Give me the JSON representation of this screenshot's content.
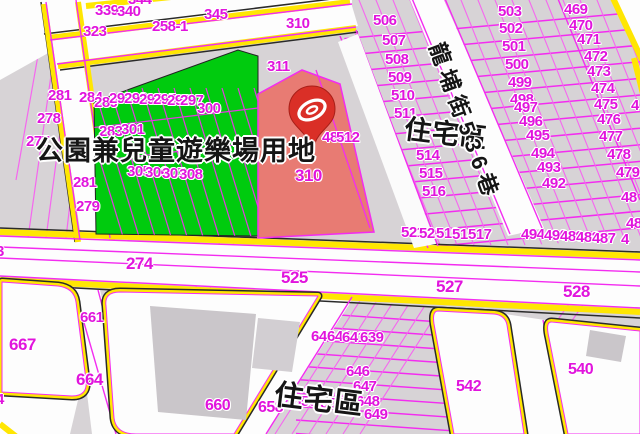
{
  "map": {
    "kind": "cadastral-zoning-map",
    "zone_colors": {
      "park": "#00cb0e",
      "selected_parcel": "#e87b73",
      "road_edge": "#ffe602",
      "parcel_line": "#f32cf0",
      "parcel_label": "#e114dd"
    },
    "marker": {
      "name": "map-pin",
      "on_parcel": "310",
      "color": "#da2f27"
    },
    "zone_texts": {
      "park": "公園兼兒童遊樂場用地",
      "residential_upper": "住宅區",
      "residential_lower": "住宅區",
      "street": "龍埔街536巷"
    },
    "labels": [
      {
        "t": "344",
        "x": 128,
        "y": -8
      },
      {
        "t": "339",
        "x": 95,
        "y": 3
      },
      {
        "t": "340",
        "x": 117,
        "y": 4
      },
      {
        "t": "345",
        "x": 204,
        "y": 7
      },
      {
        "t": "323",
        "x": 83,
        "y": 24
      },
      {
        "t": "258-1",
        "x": 152,
        "y": 19
      },
      {
        "t": "310",
        "x": 286,
        "y": 16
      },
      {
        "t": "311",
        "x": 267,
        "y": 59
      },
      {
        "t": "281",
        "x": 48,
        "y": 88
      },
      {
        "t": "284",
        "x": 79,
        "y": 90
      },
      {
        "t": "278",
        "x": 37,
        "y": 111
      },
      {
        "t": "277",
        "x": 26,
        "y": 134
      },
      {
        "t": "281",
        "x": 73,
        "y": 175
      },
      {
        "t": "279",
        "x": 76,
        "y": 199
      },
      {
        "t": "3",
        "x": -4,
        "y": 244
      },
      {
        "t": "4",
        "x": -4,
        "y": 392
      },
      {
        "t": "289",
        "x": 94,
        "y": 95
      },
      {
        "t": "292",
        "x": 109,
        "y": 91
      },
      {
        "t": "293",
        "x": 124,
        "y": 91
      },
      {
        "t": "294",
        "x": 139,
        "y": 92
      },
      {
        "t": "295",
        "x": 153,
        "y": 92
      },
      {
        "t": "296",
        "x": 167,
        "y": 93
      },
      {
        "t": "297",
        "x": 180,
        "y": 93
      },
      {
        "t": "283",
        "x": 99,
        "y": 124
      },
      {
        "t": "301",
        "x": 121,
        "y": 122
      },
      {
        "t": "300",
        "x": 197,
        "y": 101
      },
      {
        "t": "305",
        "x": 127,
        "y": 164
      },
      {
        "t": "306",
        "x": 145,
        "y": 165
      },
      {
        "t": "307",
        "x": 162,
        "y": 166
      },
      {
        "t": "308",
        "x": 179,
        "y": 167
      },
      {
        "t": "310",
        "x": 295,
        "y": 167,
        "s": 17
      },
      {
        "t": "488",
        "x": 322,
        "y": 130
      },
      {
        "t": "512",
        "x": 336,
        "y": 130
      },
      {
        "t": "506",
        "x": 373,
        "y": 13
      },
      {
        "t": "507",
        "x": 382,
        "y": 33
      },
      {
        "t": "508",
        "x": 385,
        "y": 52
      },
      {
        "t": "509",
        "x": 388,
        "y": 70
      },
      {
        "t": "510",
        "x": 391,
        "y": 88
      },
      {
        "t": "511",
        "x": 394,
        "y": 106
      },
      {
        "t": "514",
        "x": 416,
        "y": 148
      },
      {
        "t": "515",
        "x": 419,
        "y": 166
      },
      {
        "t": "516",
        "x": 422,
        "y": 184
      },
      {
        "t": "503",
        "x": 498,
        "y": 4
      },
      {
        "t": "502",
        "x": 499,
        "y": 21
      },
      {
        "t": "501",
        "x": 502,
        "y": 39
      },
      {
        "t": "500",
        "x": 505,
        "y": 57
      },
      {
        "t": "499",
        "x": 508,
        "y": 75
      },
      {
        "t": "498",
        "x": 510,
        "y": 92
      },
      {
        "t": "497",
        "x": 514,
        "y": 100
      },
      {
        "t": "496",
        "x": 519,
        "y": 114
      },
      {
        "t": "495",
        "x": 526,
        "y": 128
      },
      {
        "t": "494",
        "x": 531,
        "y": 146
      },
      {
        "t": "493",
        "x": 537,
        "y": 160
      },
      {
        "t": "492",
        "x": 542,
        "y": 176
      },
      {
        "t": "469",
        "x": 564,
        "y": 2
      },
      {
        "t": "470",
        "x": 569,
        "y": 18
      },
      {
        "t": "471",
        "x": 577,
        "y": 32
      },
      {
        "t": "472",
        "x": 584,
        "y": 49
      },
      {
        "t": "473",
        "x": 587,
        "y": 64
      },
      {
        "t": "474",
        "x": 591,
        "y": 81
      },
      {
        "t": "475",
        "x": 594,
        "y": 97
      },
      {
        "t": "4",
        "x": 631,
        "y": 98
      },
      {
        "t": "476",
        "x": 597,
        "y": 112
      },
      {
        "t": "477",
        "x": 599,
        "y": 129
      },
      {
        "t": "478",
        "x": 607,
        "y": 147
      },
      {
        "t": "479",
        "x": 616,
        "y": 165
      },
      {
        "t": "48",
        "x": 621,
        "y": 190
      },
      {
        "t": "48",
        "x": 626,
        "y": 216
      },
      {
        "t": "521",
        "x": 401,
        "y": 225
      },
      {
        "t": "520",
        "x": 419,
        "y": 226
      },
      {
        "t": "519",
        "x": 436,
        "y": 226
      },
      {
        "t": "518",
        "x": 452,
        "y": 227
      },
      {
        "t": "517",
        "x": 468,
        "y": 227
      },
      {
        "t": "494",
        "x": 521,
        "y": 227
      },
      {
        "t": "490",
        "x": 544,
        "y": 228
      },
      {
        "t": "489",
        "x": 560,
        "y": 229
      },
      {
        "t": "488",
        "x": 576,
        "y": 230
      },
      {
        "t": "487",
        "x": 592,
        "y": 231
      },
      {
        "t": "4",
        "x": 621,
        "y": 232
      },
      {
        "t": "274",
        "x": 126,
        "y": 255,
        "s": 17
      },
      {
        "t": "525",
        "x": 281,
        "y": 269,
        "s": 17
      },
      {
        "t": "527",
        "x": 436,
        "y": 278,
        "s": 17
      },
      {
        "t": "528",
        "x": 563,
        "y": 283,
        "s": 17
      },
      {
        "t": "661",
        "x": 80,
        "y": 310
      },
      {
        "t": "667",
        "x": 9,
        "y": 336,
        "s": 17
      },
      {
        "t": "664",
        "x": 76,
        "y": 371,
        "s": 17
      },
      {
        "t": "660",
        "x": 205,
        "y": 398,
        "s": 16
      },
      {
        "t": "658",
        "x": 258,
        "y": 400,
        "s": 16
      },
      {
        "t": "656",
        "x": 293,
        "y": 394
      },
      {
        "t": "654",
        "x": 320,
        "y": 396
      },
      {
        "t": "645",
        "x": 311,
        "y": 329
      },
      {
        "t": "644",
        "x": 327,
        "y": 329
      },
      {
        "t": "641",
        "x": 342,
        "y": 330
      },
      {
        "t": "639",
        "x": 360,
        "y": 330
      },
      {
        "t": "646",
        "x": 346,
        "y": 364
      },
      {
        "t": "647",
        "x": 353,
        "y": 379
      },
      {
        "t": "648",
        "x": 356,
        "y": 394
      },
      {
        "t": "649",
        "x": 364,
        "y": 407
      },
      {
        "t": "542",
        "x": 456,
        "y": 379,
        "s": 16
      },
      {
        "t": "540",
        "x": 568,
        "y": 362,
        "s": 16
      },
      {
        "t": "公園兼兒童遊樂場用地",
        "x": 36,
        "y": 138,
        "k": "z",
        "s": 27
      },
      {
        "t": "住宅區",
        "x": 406,
        "y": 116,
        "k": "z",
        "s": 27,
        "r": 7
      },
      {
        "t": "住宅區",
        "x": 276,
        "y": 381,
        "k": "z",
        "s": 29,
        "r": 7
      },
      {
        "t": "龍埔街536巷",
        "x": 446,
        "y": 40,
        "k": "st",
        "s": 22,
        "r": 70
      }
    ]
  }
}
